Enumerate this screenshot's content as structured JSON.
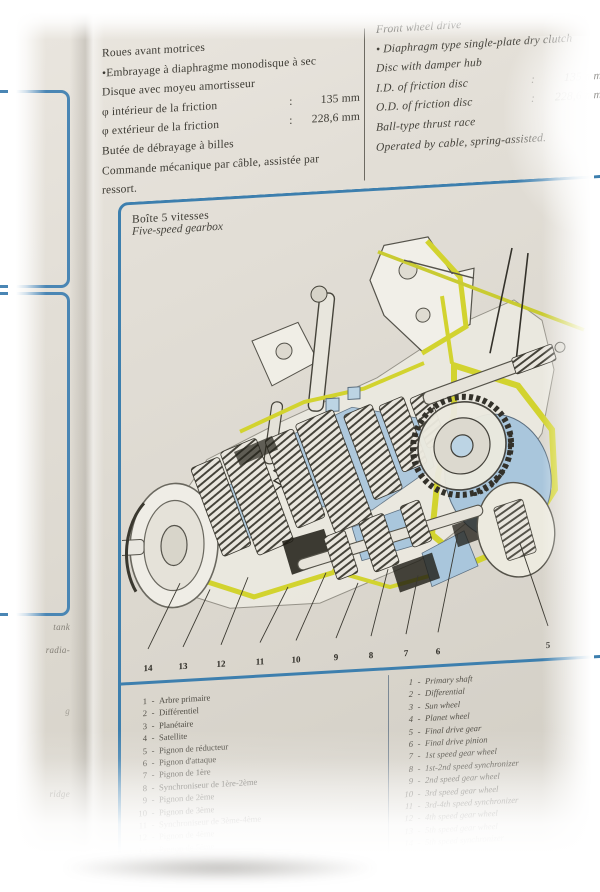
{
  "specs_fr": {
    "lines": [
      {
        "t": "Roues avant motrices"
      },
      {
        "t": "•Embrayage à diaphragme monodisque à sec"
      },
      {
        "t": "Disque avec moyeu amortisseur"
      },
      {
        "t": "φ intérieur de la friction",
        "c": ":",
        "v": "135 mm"
      },
      {
        "t": "φ extérieur de la friction",
        "c": ":",
        "v": "228,6 mm"
      },
      {
        "t": "Butée de débrayage à billes"
      },
      {
        "t": "Commande mécanique par câble, assistée par"
      },
      {
        "t": "ressort."
      }
    ]
  },
  "specs_en": {
    "lines": [
      {
        "t": "Front wheel drive"
      },
      {
        "t": "• Diaphragm type single-plate dry clutch"
      },
      {
        "t": "Disc with damper hub"
      },
      {
        "t": "I.D. of friction disc",
        "c": ":",
        "v": "135 mm"
      },
      {
        "t": "O.D. of friction disc",
        "c": ":",
        "v": "228,6 mm"
      },
      {
        "t": "Ball-type thrust race"
      },
      {
        "t": "Operated by cable, spring-assisted."
      }
    ]
  },
  "box": {
    "title_fr": "Boîte 5 vitesses",
    "title_en": "Five-speed gearbox"
  },
  "diagram": {
    "callouts": [
      "14",
      "13",
      "12",
      "11",
      "10",
      "9",
      "8",
      "7",
      "6",
      "5"
    ]
  },
  "legend_fr": {
    "items": [
      {
        "n": "1",
        "label": "Arbre primaire"
      },
      {
        "n": "2",
        "label": "Différentiel"
      },
      {
        "n": "3",
        "label": "Planétaire"
      },
      {
        "n": "4",
        "label": "Satellite"
      },
      {
        "n": "5",
        "label": "Pignon de réducteur"
      },
      {
        "n": "6",
        "label": "Pignon d'attaque"
      },
      {
        "n": "7",
        "label": "Pignon de 1ère"
      },
      {
        "n": "8",
        "label": "Synchroniseur de 1ère-2ème"
      },
      {
        "n": "9",
        "label": "Pignon de 2ème"
      },
      {
        "n": "10",
        "label": "Pignon de 3ème"
      },
      {
        "n": "11",
        "label": "Synchroniseur de 3ème-4ème"
      },
      {
        "n": "12",
        "label": "Pignon de 4ème"
      },
      {
        "n": "13",
        "label": "Pignon de 5ème"
      }
    ]
  },
  "legend_en": {
    "items": [
      {
        "n": "1",
        "label": "Primary shaft"
      },
      {
        "n": "2",
        "label": "Differential"
      },
      {
        "n": "3",
        "label": "Sun wheel"
      },
      {
        "n": "4",
        "label": "Planet wheel"
      },
      {
        "n": "5",
        "label": "Final drive gear"
      },
      {
        "n": "6",
        "label": "Final drive pinion"
      },
      {
        "n": "7",
        "label": "1st speed gear wheel"
      },
      {
        "n": "8",
        "label": "1st-2nd speed synchronizer"
      },
      {
        "n": "9",
        "label": "2nd speed gear wheel"
      },
      {
        "n": "10",
        "label": "3rd speed gear wheel"
      },
      {
        "n": "11",
        "label": "3rd-4th speed synchronizer"
      },
      {
        "n": "12",
        "label": "4th speed gear wheel"
      },
      {
        "n": "13",
        "label": "5th speed gear wheel"
      },
      {
        "n": "14",
        "label": "5th speed synchronizer"
      }
    ]
  },
  "margin": {
    "fragments": [
      "tank",
      "radia-",
      "g",
      "ridge"
    ]
  },
  "colors": {
    "accent_blue": "#3d7fae",
    "prev_page_blue": "#4a86b4",
    "diagram_blue": "#a9c6dc",
    "diagram_yellow": "#d2d32f",
    "paper": "#dfdbd3",
    "ink": "#3c3a33"
  }
}
